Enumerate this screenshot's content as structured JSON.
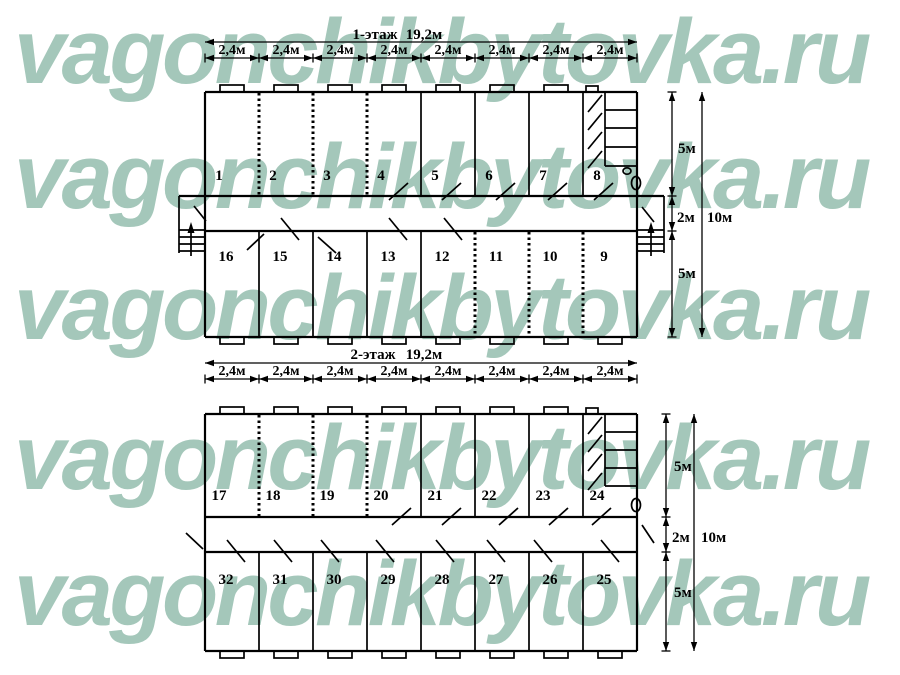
{
  "watermark": {
    "text": "vagonchikbytovka.ru",
    "color": "#a4c7ba"
  },
  "floor1": {
    "title": "1-этаж",
    "total_length": "19,2м",
    "segment_length": "2,4м",
    "top_rooms": [
      "1",
      "2",
      "3",
      "4",
      "5",
      "6",
      "7",
      "8"
    ],
    "bottom_rooms": [
      "16",
      "15",
      "14",
      "13",
      "12",
      "11",
      "10",
      "9"
    ],
    "heights": {
      "top": "5м",
      "corridor": "2м",
      "bottom": "5м",
      "total": "10м"
    }
  },
  "floor2": {
    "title": "2-этаж",
    "total_length": "19,2м",
    "segment_length": "2,4м",
    "top_rooms": [
      "17",
      "18",
      "19",
      "20",
      "21",
      "22",
      "23",
      "24"
    ],
    "bottom_rooms": [
      "32",
      "31",
      "30",
      "29",
      "28",
      "27",
      "26",
      "25"
    ],
    "heights": {
      "top": "5м",
      "corridor": "2м",
      "bottom": "5м",
      "total": "10м"
    }
  }
}
